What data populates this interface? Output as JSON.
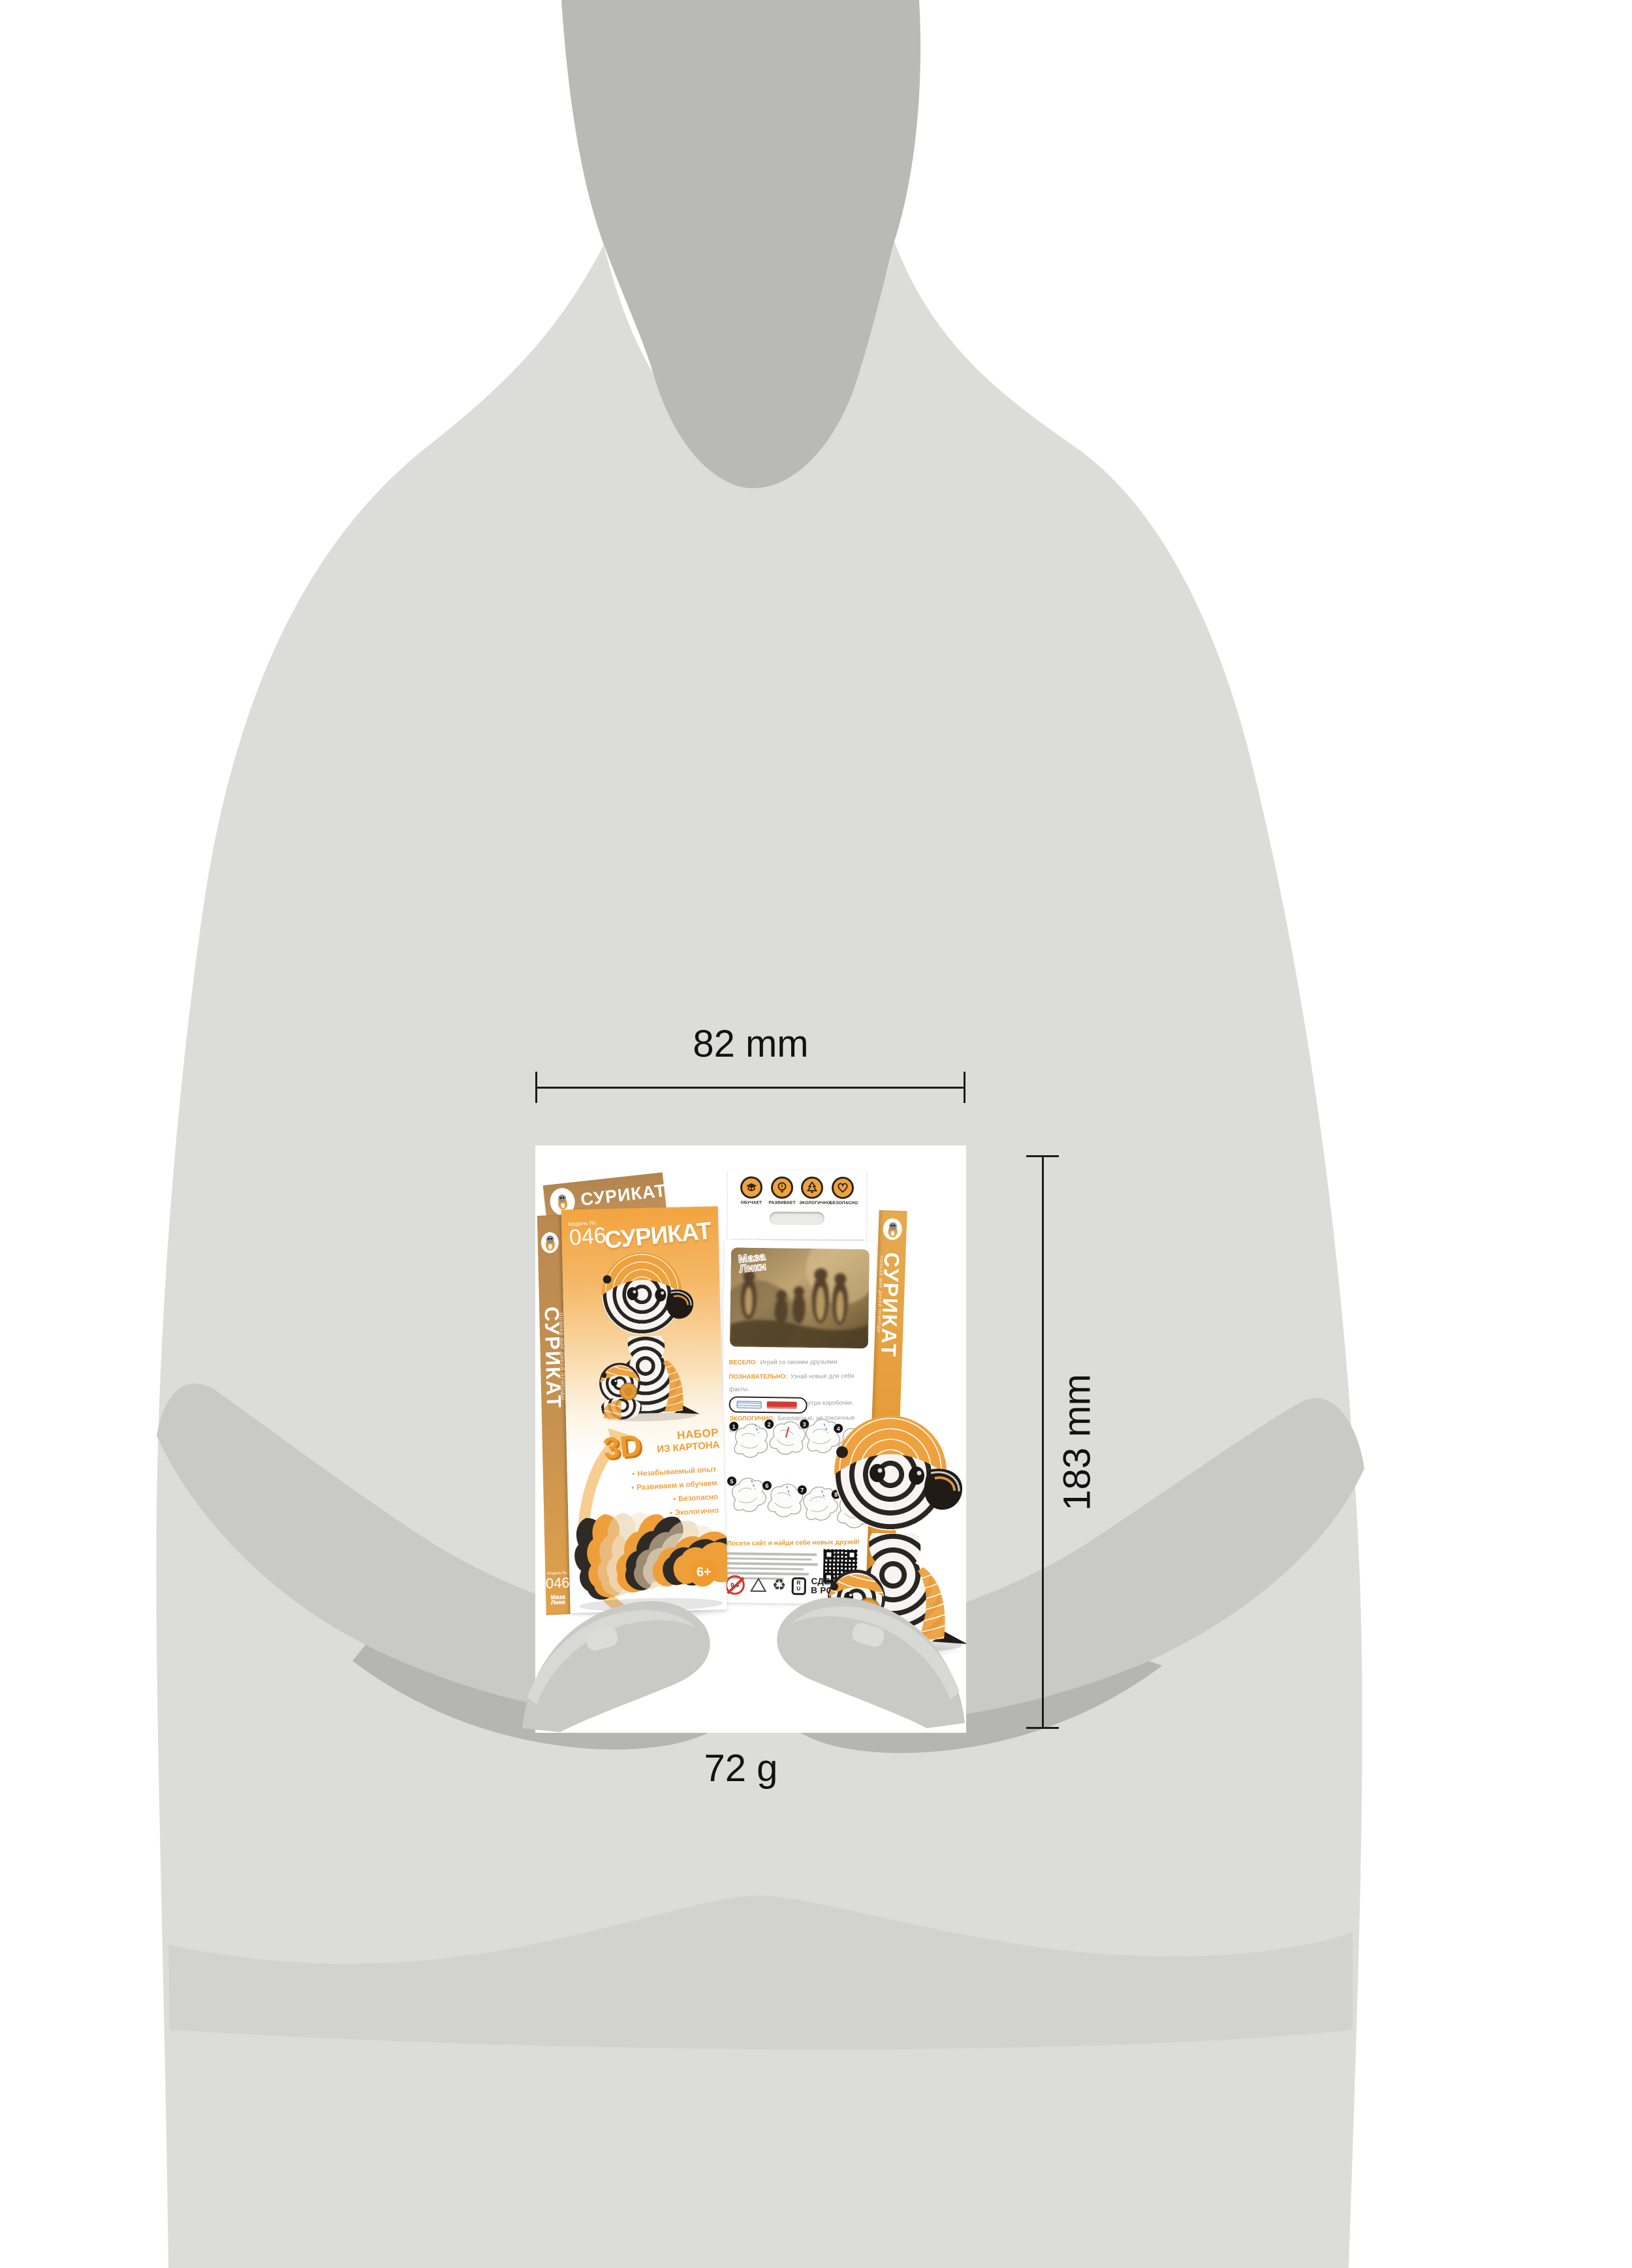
{
  "annotations": {
    "width": "82 mm",
    "height": "183 mm",
    "weight": "72 g"
  },
  "front_box": {
    "flap": {
      "title": "СУРИКАТ"
    },
    "model_label": "Модель №.",
    "model_number": "046",
    "title": "СУРИКАТ",
    "three_d": "3D",
    "kit_line1": "НАБОР",
    "kit_line2": "ИЗ КАРТОНА",
    "bullets": [
      "Незабываемый опыт",
      "Развиваем и обучаем",
      "Безопасно",
      "Экологично"
    ],
    "age_badge": "6+",
    "spine": {
      "tagline": "ПОЗНАЙ МИР ДИКОЙ ПРИРОДЫ",
      "title": "СУРИКАТ",
      "model_label": "Модель №.",
      "model_number": "046",
      "brand_line1": "Маза",
      "brand_line2": "Лики"
    }
  },
  "back_box": {
    "badges": [
      {
        "icon": "graduation-cap-icon",
        "label": "ОБУЧАЕТ"
      },
      {
        "icon": "lightbulb-icon",
        "label": "РАЗВИВАЕТ"
      },
      {
        "icon": "fir-tree-icon",
        "label": "ЭКОЛОГИЧНО"
      },
      {
        "icon": "heart-icon",
        "label": "БЕЗОПАСНО"
      }
    ],
    "photo_brand_line1": "Маза",
    "photo_brand_line2": "Лики",
    "features": [
      {
        "label": "ВЕСЕЛО:",
        "text": "Играй со своими друзьями."
      },
      {
        "label": "ПОЗНАВАТЕЛЬНО:",
        "text": "Узнай новые для себя факты."
      },
      {
        "label": "ЛЕГКО:",
        "text": "Всё, что нужно, внутри коробочки."
      },
      {
        "label": "ЭКОЛОГИЧНО:",
        "text": "Безопасные, не токсичные материалы."
      }
    ],
    "steps": [
      "1",
      "2",
      "3",
      "4",
      "5",
      "6",
      "7",
      "8"
    ],
    "site_invite": "Посети сайт и найди себе новых друзей!",
    "qr_caption": "mazaliki.ru",
    "age_warning": "0-3",
    "ru_mark_top": "R",
    "ru_mark_bottom": "U",
    "made_in_line1": "СДЕЛАНО",
    "made_in_line2": "В РОССИИ",
    "spine": {
      "tagline": "ПОЗНАЙ МИР ДИКОЙ ПРИРОДЫ",
      "title": "СУРИКАТ",
      "model_number": "046",
      "brand_line1": "Маза",
      "brand_line2": "Лики"
    }
  },
  "colors": {
    "accent_orange": "#F0A23C",
    "tan": "#BE9159",
    "silhouette_light": "#DCDCDA",
    "silhouette_dark": "#B9B9B6",
    "hands": "#C9C9C6"
  }
}
